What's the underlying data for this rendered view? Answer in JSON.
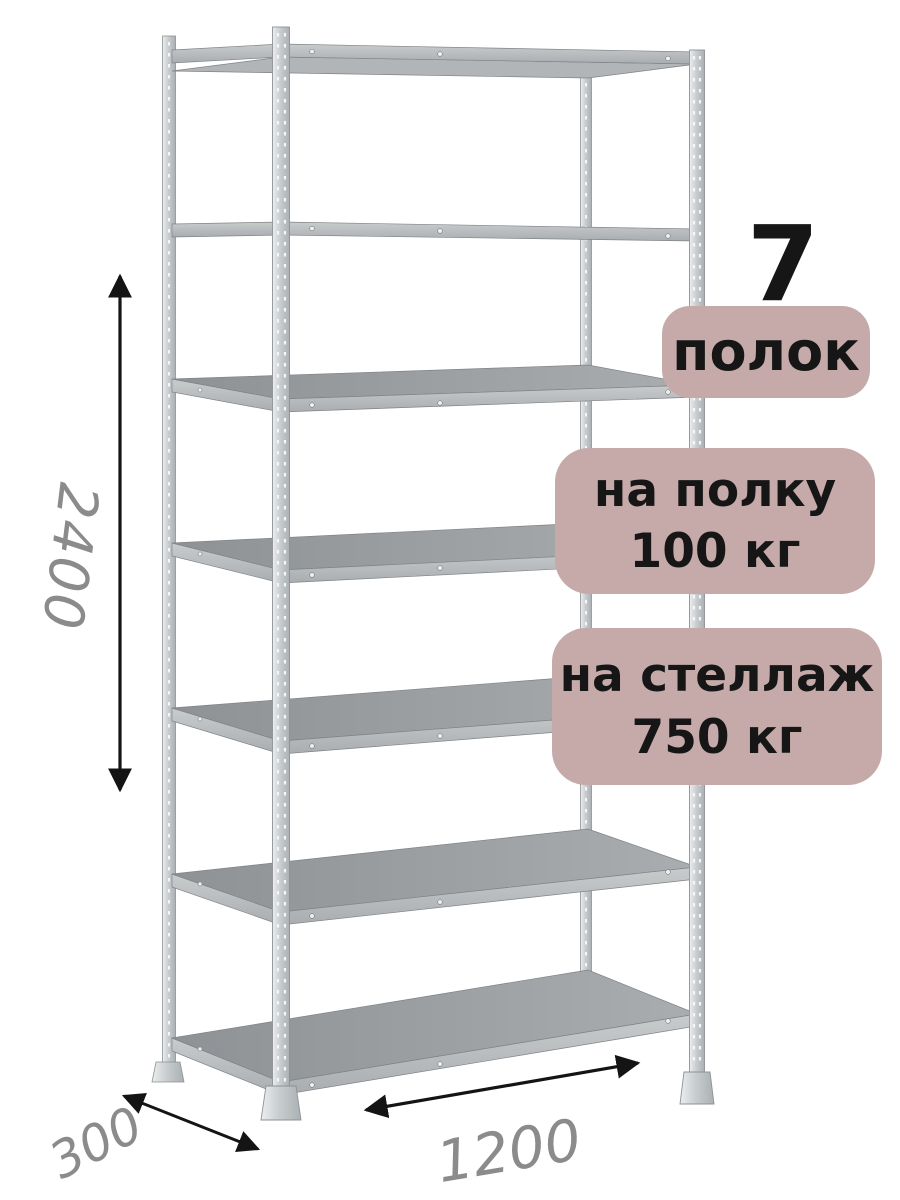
{
  "annotations": {
    "shelf_count": "7",
    "badges": [
      {
        "id": "shelf-count",
        "text": "полок"
      },
      {
        "id": "per-shelf-load",
        "line1": "на полку",
        "line2": "100 кг"
      },
      {
        "id": "per-rack-load",
        "line1": "на стеллаж",
        "line2": "750 кг"
      }
    ]
  },
  "dimensions": {
    "height": "2400",
    "depth": "300",
    "width": "1200"
  },
  "colors": {
    "badge_bg": "#c6aaaa",
    "badge_text": "#161616",
    "dimension_text": "#8b8b8b",
    "arrow": "#141414",
    "background": "#ffffff"
  }
}
